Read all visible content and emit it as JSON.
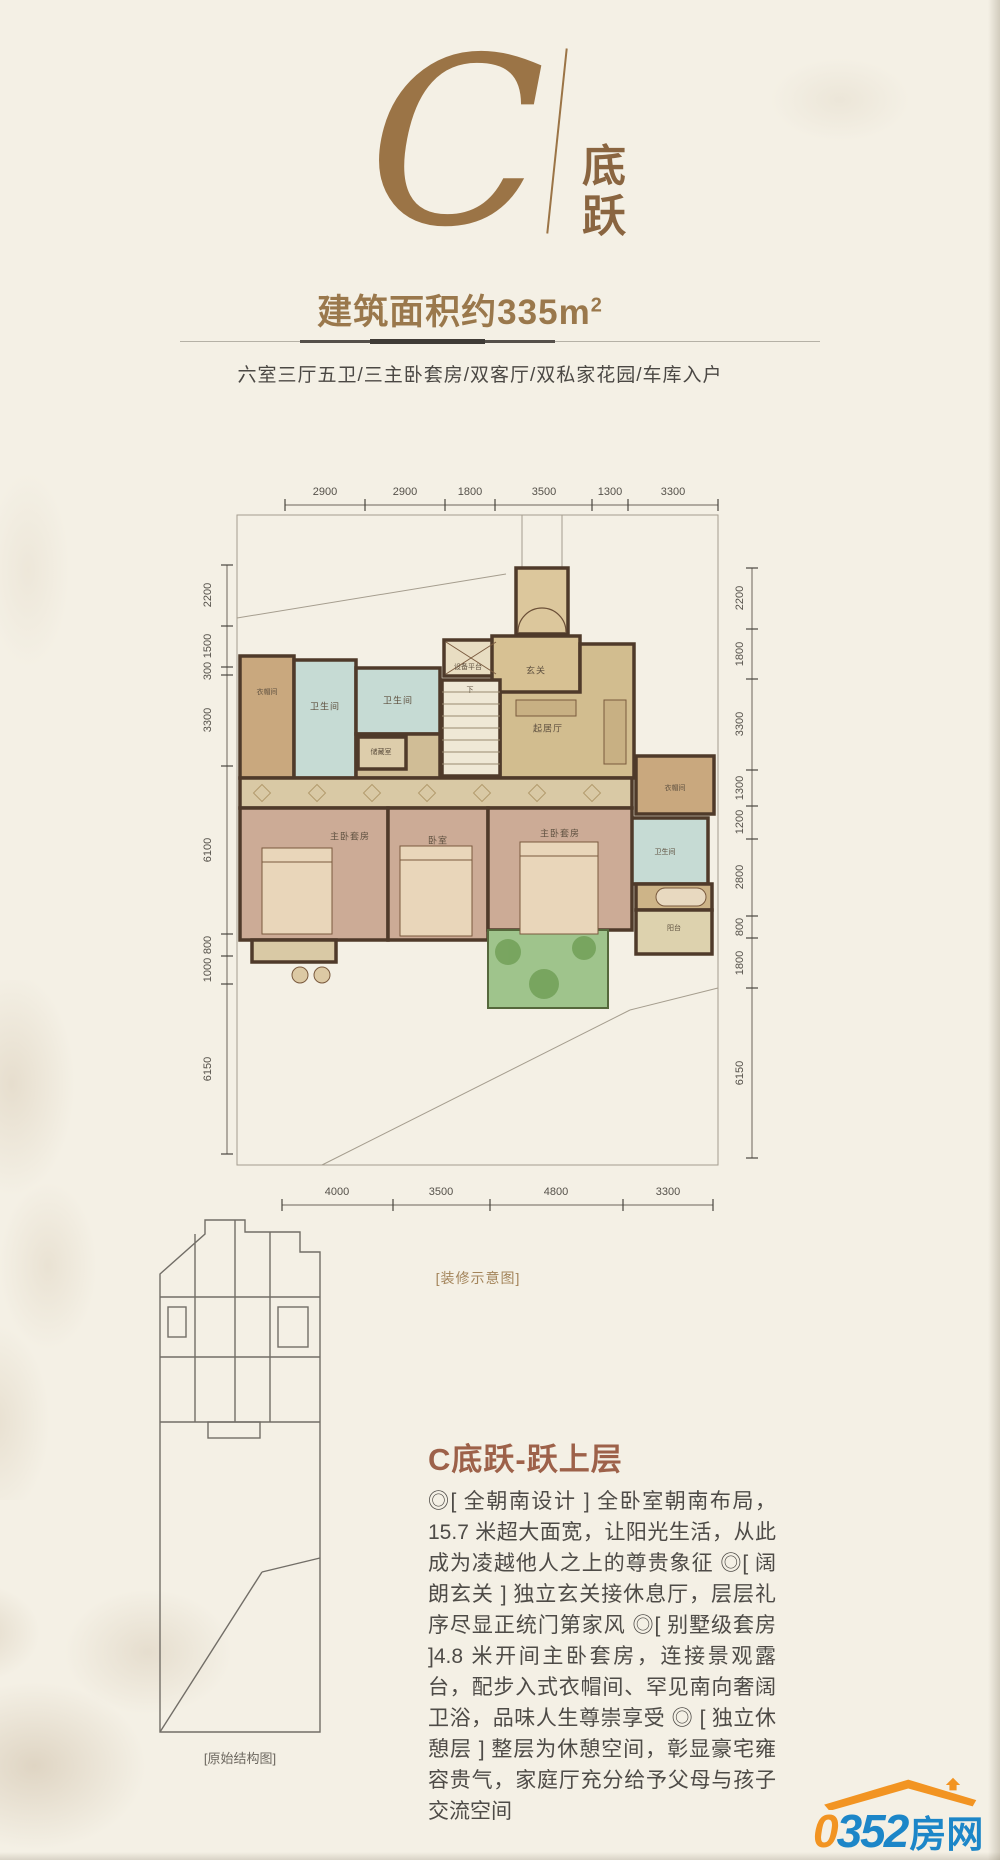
{
  "colors": {
    "paper": "#f4f0e5",
    "title_brown": "#9b7446",
    "heading_brown": "#9d6149",
    "wall_brown": "#4f3a2a",
    "logo_orange": "#f29422",
    "logo_blue": "#1c86c8"
  },
  "header": {
    "plan_letter": "C",
    "plan_tag_line1": "底",
    "plan_tag_line2": "跃",
    "area_label": "建筑面积约335m",
    "area_sup": "2",
    "features": "六室三厅五卫/三主卧套房/双客厅/双私家花园/车库入户"
  },
  "plan": {
    "caption": "[装修示意图]",
    "dims_top": [
      "2900",
      "2900",
      "1800",
      "3500",
      "1300",
      "3300"
    ],
    "dims_bottom": [
      "4000",
      "3500",
      "4800",
      "3300"
    ],
    "dims_left": [
      "2200",
      "1500",
      "300",
      "3300",
      "6100",
      "800",
      "1000",
      "6150"
    ],
    "dims_right": [
      "2200",
      "1800",
      "3300",
      "1300",
      "1200",
      "2800",
      "800",
      "1800",
      "6150"
    ],
    "rooms": [
      {
        "label": "设备平台"
      },
      {
        "label": "玄关"
      },
      {
        "label": "卫生间"
      },
      {
        "label": "卫生间"
      },
      {
        "label": "储藏室"
      },
      {
        "label": "起居厅"
      },
      {
        "label": "衣帽间"
      },
      {
        "label": "下"
      },
      {
        "label": "主卧套房"
      },
      {
        "label": "卧室"
      },
      {
        "label": "主卧套房"
      },
      {
        "label": "衣帽间"
      },
      {
        "label": "卫生间"
      },
      {
        "label": "阳台"
      }
    ]
  },
  "structure": {
    "caption": "[原始结构图]"
  },
  "detail": {
    "heading": "C底跃-跃上层",
    "body": "◎[ 全朝南设计 ] 全卧室朝南布局，15.7 米超大面宽，让阳光生活，从此成为凌越他人之上的尊贵象征 ◎[ 阔朗玄关 ] 独立玄关接休息厅，层层礼序尽显正统门第家风 ◎[ 别墅级套房 ]4.8 米开间主卧套房，连接景观露台，配步入式衣帽间、罕见南向奢阔卫浴，品味人生尊崇享受 ◎ [ 独立休憩层 ] 整层为休憩空间，彰显豪宅雍容贵气，家庭厅充分给予父母与孩子交流空间"
  },
  "footer": {
    "logo_zero": "0",
    "logo_num": "352",
    "logo_cn": "房网",
    "logo_url": "www.0352fang.com"
  }
}
